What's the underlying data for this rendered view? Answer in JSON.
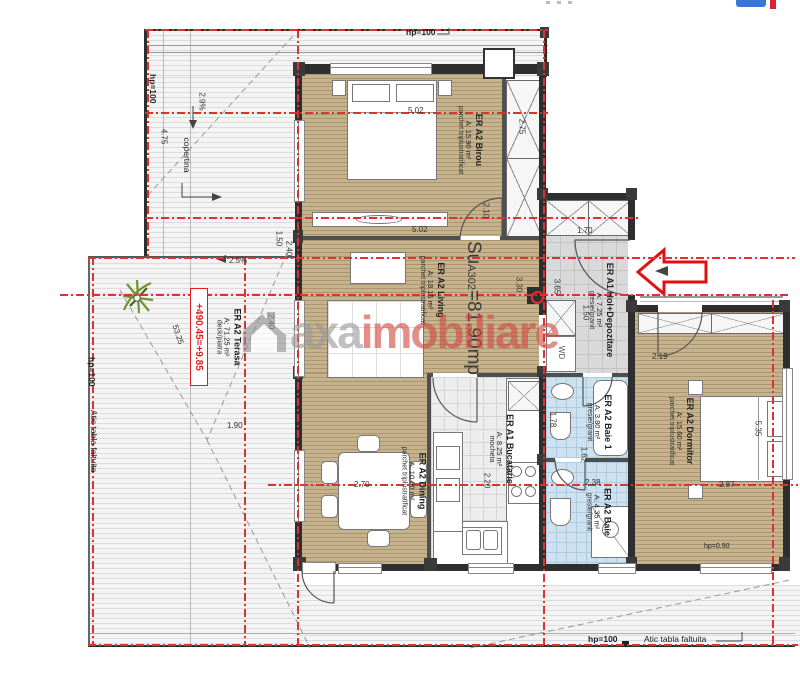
{
  "title_block": {
    "su_prefix": "Su",
    "su_sub": "A302",
    "su_suffix": "=81.90mp"
  },
  "watermark": {
    "brand_gray": "axa",
    "brand_red": "imobiliare"
  },
  "rooms": [
    {
      "code": "ER A2 Birou",
      "area": "A: 15.90 m²",
      "finish": "parchet triplustratificat"
    },
    {
      "code": "ER A2 Living",
      "area": "A: 18.15 m²",
      "finish": "parchet triplustratificat"
    },
    {
      "code": "ER A2 Dining",
      "area": "A: 10.00 m²",
      "finish": "parchet triplustratificat"
    },
    {
      "code": "ER A1 Bucatarie",
      "area": "A: 8.25 m²",
      "finish": "mocheta"
    },
    {
      "code": "ER A1 Hol+Depozitare",
      "area": "A: 7.25 m²",
      "finish": "gresie/granit"
    },
    {
      "code": "ER A2 Baie 1",
      "area": "A: 3.80 m²",
      "finish": "gresie/granit"
    },
    {
      "code": "ER A2 Baie",
      "area": "A: 4.35 m²",
      "finish": "gresie/granit"
    },
    {
      "code": "ER A2 Dormitor",
      "area": "A: 15.60 m²",
      "finish": "parchet triplustratificat"
    },
    {
      "code": "ER A2 Terasa",
      "area": "A: 71.25 m²",
      "finish": "deck/piatra"
    }
  ],
  "annotations": {
    "level_mark": "+490.45=+9.85",
    "canopy": "copertina",
    "washer_dryer": "WD",
    "parapet_height": "hp=100",
    "attic_note": "Atic tabla faltuita",
    "slope_top": "2.9%",
    "slope_mid": "2.5%",
    "window_height": "hp=0.90"
  },
  "dims": [
    {
      "t": "5.02"
    },
    {
      "t": "5.02"
    },
    {
      "t": "2.75"
    },
    {
      "t": "2.10"
    },
    {
      "t": "1.50"
    },
    {
      "t": "2.40"
    },
    {
      "t": "3.30"
    },
    {
      "t": "1.70"
    },
    {
      "t": "3.65"
    },
    {
      "t": "2.19"
    },
    {
      "t": "1.78"
    },
    {
      "t": "2.38"
    },
    {
      "t": "2.20"
    },
    {
      "t": "2.70"
    },
    {
      "t": "5.35"
    },
    {
      "t": "2.87"
    },
    {
      "t": "1.90"
    },
    {
      "t": "53.25"
    },
    {
      "t": "4.75"
    },
    {
      "t": "2.9%"
    },
    {
      "t": "2.5%"
    },
    {
      "t": "1.62"
    },
    {
      "t": "1.50"
    },
    {
      "t": "2.40"
    }
  ],
  "icons": {
    "entrance_arrow": "entrance-direction-arrow",
    "plant": "plant-symbol",
    "house_logo": "house-logo"
  },
  "colors": {
    "axis_red": "#e03131",
    "wood_floor": "#c6b28c",
    "bath_tile": "#cde1f0",
    "hall_tile": "#d9d9d9",
    "watermark_gray": "#9a9a9a",
    "watermark_red": "#d24a42",
    "arrow_red": "#e01010"
  }
}
